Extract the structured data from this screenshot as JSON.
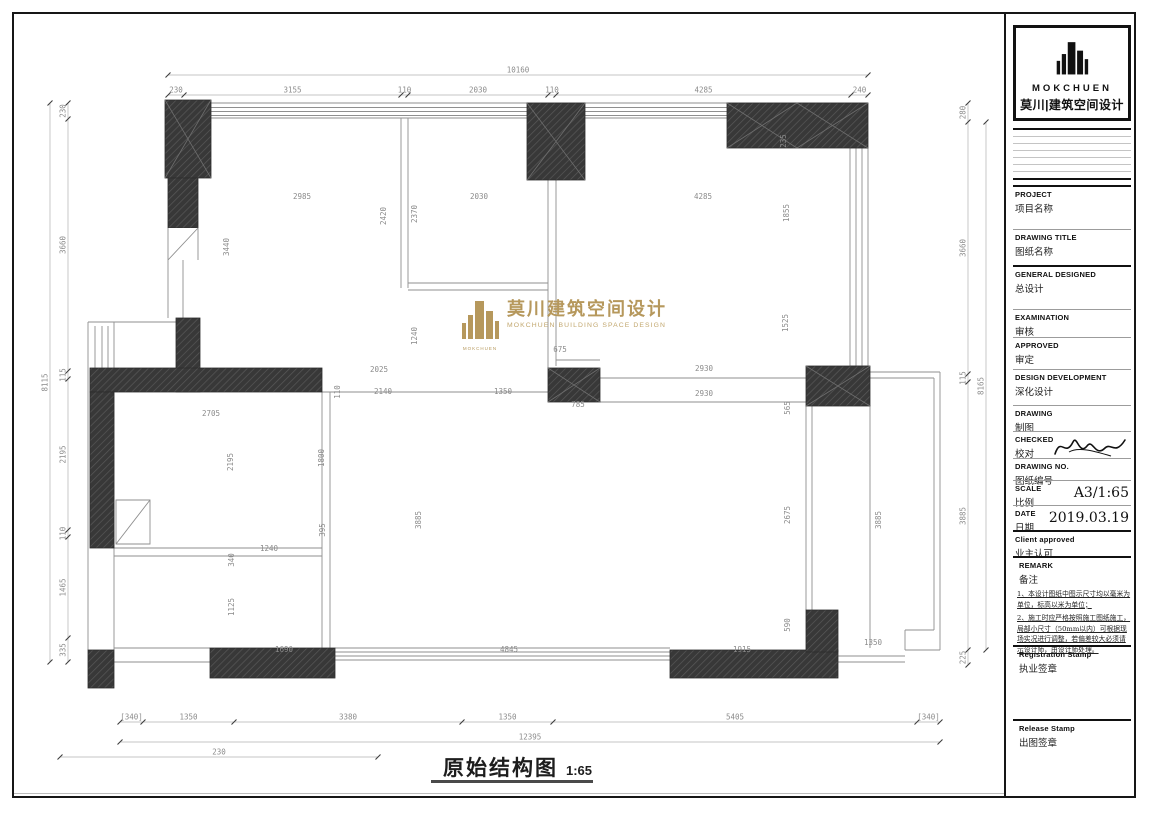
{
  "colors": {
    "accent_gold": "#b6985c",
    "wall_dark": "#383838",
    "dim_gray": "#8b8b8b"
  },
  "watermark": {
    "brand": "MOKCHUEN",
    "cn": "莫川建筑空间设计",
    "en": "MOKCHUEN BUILDING SPACE DESIGN"
  },
  "footer": {
    "title": "原始结构图",
    "scale": "1:65"
  },
  "title_block": {
    "logo": {
      "brand": "MOKCHUEN",
      "brand_cn": "莫川|建筑空间设计"
    },
    "fields": [
      {
        "en": "PROJECT",
        "cn": "项目名称"
      },
      {
        "en": "DRAWING TITLE",
        "cn": "图纸名称"
      },
      {
        "en": "GENERAL  DESIGNED",
        "cn": "总设计"
      },
      {
        "en": "EXAMINATION",
        "cn": "审核"
      },
      {
        "en": "APPROVED",
        "cn": "审定"
      },
      {
        "en": "DESIGN DEVELOPMENT",
        "cn": "深化设计"
      },
      {
        "en": "DRAWING",
        "cn": "制图"
      },
      {
        "en": "CHECKED",
        "cn": "校对"
      },
      {
        "en": "DRAWING NO.",
        "cn": "图纸编号"
      },
      {
        "en": "SCALE",
        "cn": "比例",
        "value": "A3/1:65"
      },
      {
        "en": "DATE",
        "cn": "日期",
        "value": "2019.03.19"
      },
      {
        "en": "Client approved",
        "cn": "业主认可"
      }
    ],
    "remark": {
      "en": "REMARK",
      "cn": "备注",
      "notes": [
        "1、本设计图纸中图示尺寸均以毫米为单位，标高以米为单位；",
        "2、施工时应严格按照施工图纸施工，局部小尺寸（50mm以内）可根据现场实况进行调整，若偏差较大必须请示设计师，由设计师处理。"
      ]
    },
    "stamps": [
      {
        "en": "Registration Stamp",
        "cn": "执业签章"
      },
      {
        "en": "Release Stamp",
        "cn": "出图签章"
      }
    ]
  },
  "plan": {
    "chains": [
      {
        "dir": "h",
        "line": [
          168,
          75,
          868,
          75
        ],
        "bounds": [
          168,
          868
        ],
        "labels": [
          "10160"
        ]
      },
      {
        "dir": "h",
        "line": [
          168,
          95,
          868,
          95
        ],
        "bounds": [
          168,
          184,
          401,
          408,
          548,
          556,
          851,
          868
        ],
        "labels": [
          "230",
          "3155",
          "110",
          "2030",
          "110",
          "4285",
          "240"
        ]
      },
      {
        "dir": "v",
        "line": [
          50,
          103,
          50,
          662
        ],
        "bounds": [
          103,
          662
        ],
        "labels": [
          "8115"
        ]
      },
      {
        "dir": "v",
        "line": [
          68,
          103,
          68,
          662
        ],
        "bounds": [
          103,
          119,
          371,
          379,
          530,
          537,
          638,
          662
        ],
        "labels": [
          "230",
          "3660",
          "115",
          "2195",
          "110",
          "1465",
          "335"
        ]
      },
      {
        "dir": "v",
        "line": [
          968,
          103,
          968,
          665
        ],
        "bounds": [
          103,
          122,
          374,
          382,
          650,
          665
        ],
        "labels": [
          "280",
          "3660",
          "115",
          "3885",
          "225"
        ]
      },
      {
        "dir": "v",
        "line": [
          986,
          122,
          986,
          650
        ],
        "bounds": [
          122,
          650
        ],
        "labels": [
          "8165"
        ]
      },
      {
        "dir": "h",
        "line": [
          120,
          722,
          940,
          722
        ],
        "bounds": [
          120,
          143,
          234,
          462,
          553,
          917,
          940
        ],
        "labels": [
          "[340]",
          "1350",
          "3380",
          "1350",
          "5405",
          "[340]"
        ]
      },
      {
        "dir": "h",
        "line": [
          120,
          742,
          940,
          742
        ],
        "bounds": [
          120,
          940
        ],
        "labels": [
          "12395"
        ]
      },
      {
        "dir": "h",
        "line": [
          60,
          757,
          378,
          757
        ],
        "bounds": [
          60,
          378
        ],
        "labels": [
          "230"
        ]
      }
    ],
    "interior_dims": [
      {
        "x": 302,
        "y": 199,
        "t": "2985"
      },
      {
        "x": 386,
        "y": 216,
        "r": 1,
        "t": "2420"
      },
      {
        "x": 417,
        "y": 214,
        "r": 1,
        "t": "2370"
      },
      {
        "x": 479,
        "y": 199,
        "t": "2030"
      },
      {
        "x": 703,
        "y": 199,
        "t": "4285"
      },
      {
        "x": 786,
        "y": 141,
        "r": 1,
        "t": "235"
      },
      {
        "x": 789,
        "y": 213,
        "r": 1,
        "t": "1855"
      },
      {
        "x": 788,
        "y": 323,
        "r": 1,
        "t": "1525"
      },
      {
        "x": 229,
        "y": 247,
        "r": 1,
        "t": "3440"
      },
      {
        "x": 417,
        "y": 336,
        "r": 1,
        "t": "1240"
      },
      {
        "x": 560,
        "y": 352,
        "t": "675"
      },
      {
        "x": 379,
        "y": 372,
        "t": "2025"
      },
      {
        "x": 340,
        "y": 392,
        "r": 1,
        "t": "110"
      },
      {
        "x": 383,
        "y": 394,
        "t": "2140"
      },
      {
        "x": 503,
        "y": 394,
        "t": "1350"
      },
      {
        "x": 578,
        "y": 407,
        "t": "785"
      },
      {
        "x": 704,
        "y": 371,
        "t": "2930"
      },
      {
        "x": 704,
        "y": 396,
        "t": "2930"
      },
      {
        "x": 790,
        "y": 408,
        "r": 1,
        "t": "565"
      },
      {
        "x": 790,
        "y": 515,
        "r": 1,
        "t": "2675"
      },
      {
        "x": 790,
        "y": 625,
        "r": 1,
        "t": "590"
      },
      {
        "x": 211,
        "y": 416,
        "t": "2705"
      },
      {
        "x": 233,
        "y": 462,
        "r": 1,
        "t": "2195"
      },
      {
        "x": 324,
        "y": 458,
        "r": 1,
        "t": "1800"
      },
      {
        "x": 325,
        "y": 530,
        "r": 1,
        "t": "395"
      },
      {
        "x": 269,
        "y": 551,
        "t": "1240"
      },
      {
        "x": 234,
        "y": 560,
        "r": 1,
        "t": "340"
      },
      {
        "x": 234,
        "y": 607,
        "r": 1,
        "t": "1125"
      },
      {
        "x": 421,
        "y": 520,
        "r": 1,
        "t": "3885"
      },
      {
        "x": 881,
        "y": 520,
        "r": 1,
        "t": "3885"
      },
      {
        "x": 284,
        "y": 652,
        "t": "1690"
      },
      {
        "x": 509,
        "y": 652,
        "t": "4845"
      },
      {
        "x": 742,
        "y": 652,
        "t": "1915"
      },
      {
        "x": 873,
        "y": 645,
        "t": "1350"
      }
    ]
  }
}
